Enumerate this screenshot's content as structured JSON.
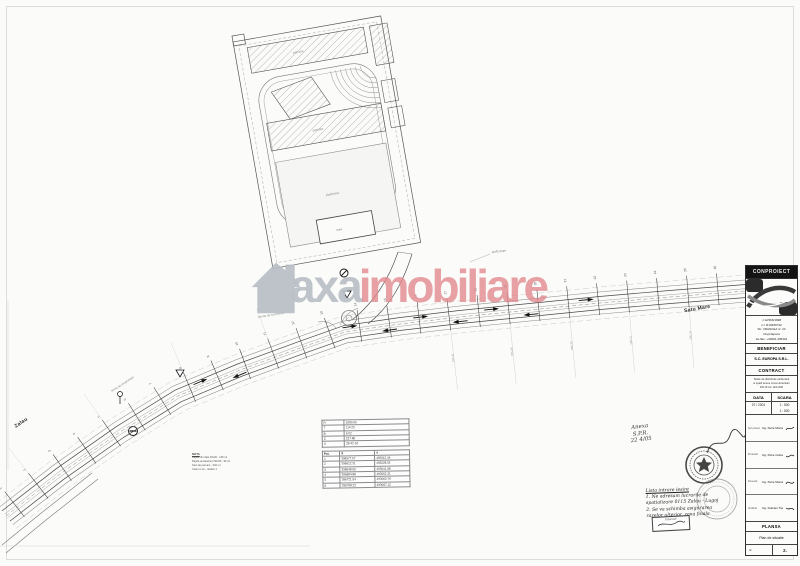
{
  "watermark": {
    "brand_primary": "axa",
    "brand_secondary": "imobiliare"
  },
  "plan": {
    "dest_right": "Satu Mare",
    "dest_left": "Zalau",
    "label_parking_top": "parcare",
    "label_parking_mid": "parcare",
    "label_platform": "platforma",
    "label_station": "statie",
    "label_profile": "profil drum",
    "label_property": "limita de proprietate",
    "label_accel": "banda de accelerare",
    "nota_title": "NOTA",
    "nota_lines": [
      "Rigola din dale 30x30 - 125 ml",
      "Rigola acostament 50x50 - 96 ml",
      "Sant de pamant - 240 ml",
      "Casiu in ax - detaliu 1"
    ],
    "station_numbers": [
      "1",
      "2",
      "3",
      "4",
      "5",
      "6",
      "7",
      "8",
      "9",
      "10",
      "11",
      "12",
      "13",
      "14",
      "15",
      "16",
      "17",
      "18",
      "19",
      "20",
      "21",
      "22",
      "23",
      "24",
      "25",
      "26"
    ],
    "elevations": [
      "295.41",
      "295.36",
      "295.28",
      "295.21",
      "295.14",
      "295.06",
      "294.97",
      "294.88",
      "294.79",
      "294.68",
      "294.57",
      "294.46"
    ]
  },
  "coord_table": {
    "top_rows": [
      [
        "R",
        "1000.00"
      ],
      [
        "T",
        "114.25"
      ],
      [
        "B",
        "6.52"
      ],
      [
        "C",
        "227.80"
      ],
      [
        "U",
        "28-42-16"
      ]
    ],
    "header": [
      "Pct.",
      "X",
      "Y"
    ],
    "rows": [
      [
        "1",
        "396577.07",
        "493012.44"
      ],
      [
        "2",
        "396612.31",
        "493028.55"
      ],
      [
        "3",
        "396648.09",
        "493041.98"
      ],
      [
        "4",
        "396684.88",
        "493052.31"
      ],
      [
        "5",
        "396721.54",
        "493060.76"
      ],
      [
        "6",
        "396758.22",
        "493067.12"
      ]
    ]
  },
  "annotations": {
    "memo_lines": [
      "Anexa",
      "S.P.R.",
      "22 4/05"
    ],
    "note_lines": [
      "Lista intrare iesire",
      "1. Ne adresam lucrarile de",
      "spatializare 0115 Zalau - Lugoj",
      "2. Se va schimba asigurarea",
      "razelor ulterior, zona finala"
    ],
    "stamp_box": "Intocmit"
  },
  "title_block": {
    "company": "CONPROIECT",
    "reg_lines": [
      "J 12/366/1998",
      "c.f. R10406732",
      "Str. VRANCEA nr. 24",
      "Cluj-Napoca",
      "tel./fax. +40264 435344"
    ],
    "beneficiar_label": "BENEFICIAR",
    "beneficiar_name": "S.C. EUROPA S.R.L.",
    "contract_label": "CONTRACT",
    "contract_lines": [
      "Statie de distributie carburanti",
      "si spatii anexe zona Hereclean",
      "DN 1F km 110+500"
    ],
    "data_label": "DATA",
    "scara_label": "SCARA",
    "data_value": "07 / 2001",
    "scara_values": [
      "1 : 500",
      "1 : 500"
    ],
    "staff": [
      {
        "role": "Sef proiect",
        "name": "Ing. Petre Muresan"
      },
      {
        "role": "Proiectat",
        "name": "Ing. Petre Ciubancan"
      },
      {
        "role": "Desenat",
        "name": "Ing. Petre Muresan"
      },
      {
        "role": "Verificat",
        "name": "Ing. Felician Trandafir"
      }
    ],
    "plansa_label": "PLANSA",
    "plansa_title": "Plan de situatie",
    "nr_label": "nr.",
    "nr_value": "2."
  }
}
